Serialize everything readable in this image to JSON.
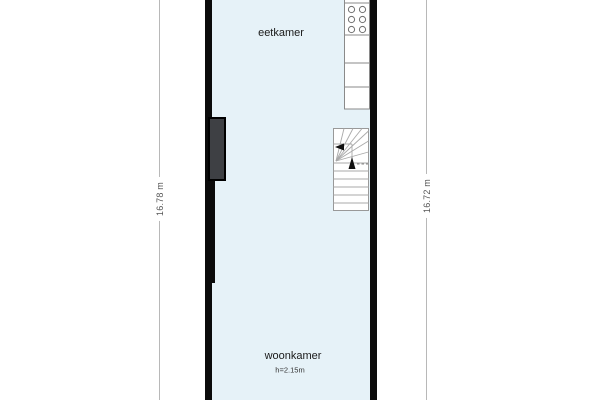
{
  "rooms": {
    "dining": {
      "label": "eetkamer"
    },
    "living": {
      "label": "woonkamer",
      "ceiling_height": "h=2.15m"
    }
  },
  "dimensions": {
    "left": "16.78 m",
    "right": "16.72 m"
  },
  "fixtures": {
    "stove": "stove-6-burner-icon",
    "counter": "kitchen-counter",
    "stairs": "staircase-with-winders",
    "chimney": "chimney-breast"
  },
  "colors": {
    "floor": "#e6f2f8",
    "wall": "#0b0b0b",
    "chimney": "#3e4044",
    "fixture_outline": "#8a8a8a",
    "dimension_line": "#b8b8b8",
    "dimension_text": "#555555",
    "label_text": "#1a1a1a"
  }
}
